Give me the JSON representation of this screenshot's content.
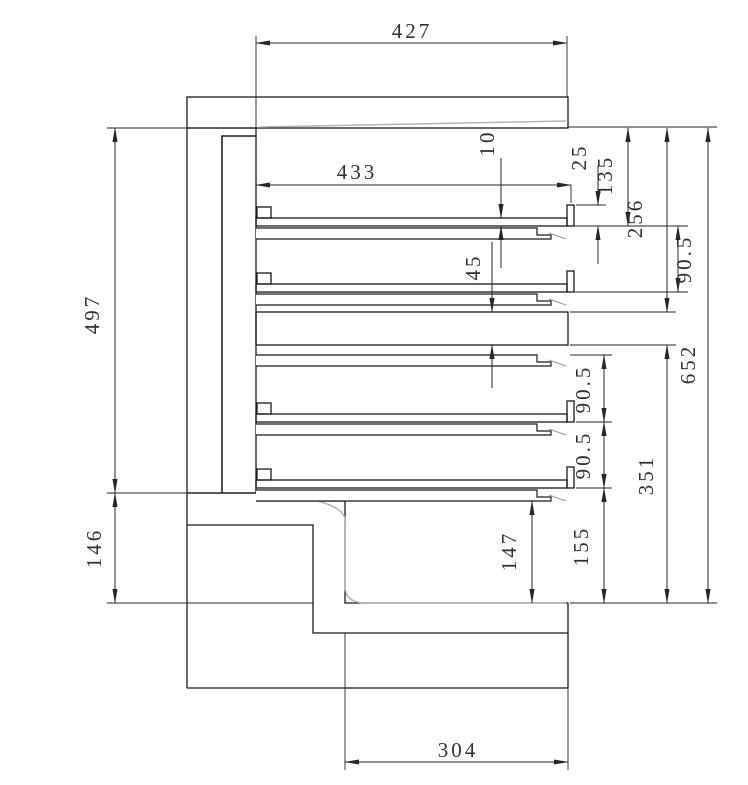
{
  "drawing": {
    "kind": "engineering-cross-section",
    "description": "Sectional CAD drawing of an insulated chamber with four shelf plates and stepped base",
    "colors": {
      "background": "#ffffff",
      "outline": "#1a1a1a",
      "dimension": "#26262c",
      "hatch": "#6a6a6a",
      "plate_fill_hatch": "#8a8a8a",
      "ghost_gray": "#b3b3b3",
      "text": "#2f2f38"
    }
  },
  "dims": {
    "d427": "427",
    "d433": "433",
    "d10": "10",
    "d45": "45",
    "d25": "25",
    "d135": "135",
    "d256": "256",
    "d90_upper": "90.5",
    "d652": "652",
    "d497": "497",
    "d146": "146",
    "d90_lower1": "90.5",
    "d90_lower2": "90.5",
    "d351": "351",
    "d155": "155",
    "d147": "147",
    "d304": "304"
  }
}
